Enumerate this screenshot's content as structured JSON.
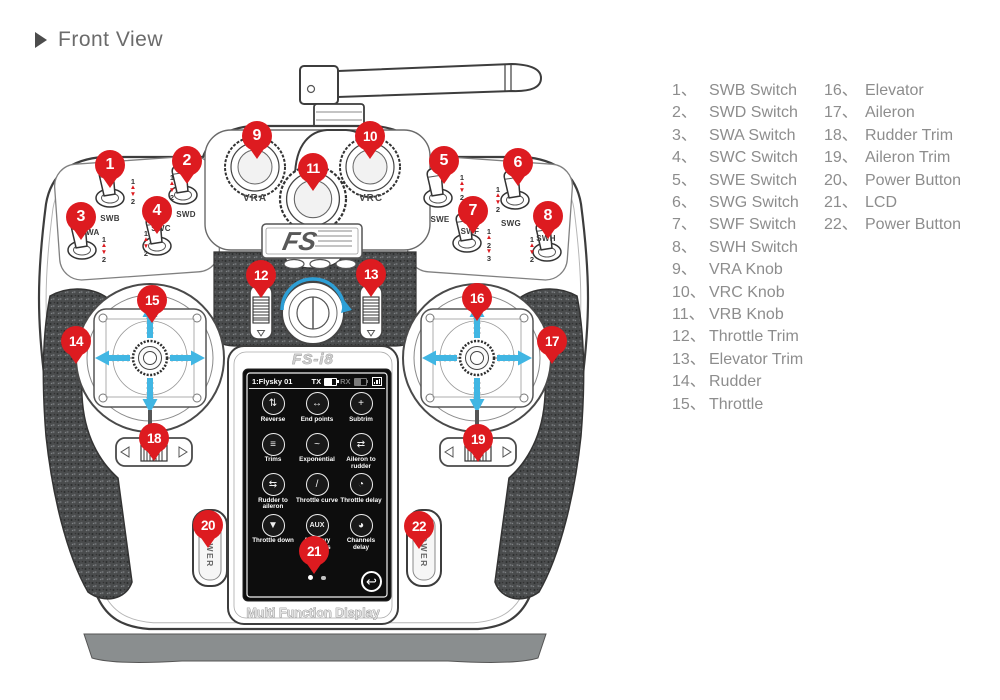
{
  "title": "Front View",
  "colors": {
    "marker-red": "#dd1b20",
    "arrow-cyan": "#41b6e3",
    "arc-blue": "#2d9fd6",
    "legend-gray": "#8d8d8d",
    "line-dark": "#3d3d3d",
    "lcd-bg": "#0d0d0d",
    "base-gray": "#8a8e8f"
  },
  "legend": {
    "separator": "、",
    "items": [
      {
        "num": "1",
        "label": "SWB Switch"
      },
      {
        "num": "2",
        "label": "SWD Switch"
      },
      {
        "num": "3",
        "label": "SWA Switch"
      },
      {
        "num": "4",
        "label": "SWC Switch"
      },
      {
        "num": "5",
        "label": "SWE  Switch"
      },
      {
        "num": "6",
        "label": "SWG Switch"
      },
      {
        "num": "7",
        "label": "SWF  Switch"
      },
      {
        "num": "8",
        "label": "SWH Switch"
      },
      {
        "num": "9",
        "label": "VRA Knob"
      },
      {
        "num": "10",
        "label": "VRC Knob"
      },
      {
        "num": "11",
        "label": "VRB Knob"
      },
      {
        "num": "12",
        "label": "Throttle Trim"
      },
      {
        "num": "13",
        "label": "Elevator Trim"
      },
      {
        "num": "14",
        "label": "Rudder"
      },
      {
        "num": "15",
        "label": "Throttle"
      },
      {
        "num": "16",
        "label": "Elevator"
      },
      {
        "num": "17",
        "label": "Aileron"
      },
      {
        "num": "18",
        "label": "Rudder Trim"
      },
      {
        "num": "19",
        "label": "Aileron Trim"
      },
      {
        "num": "20",
        "label": "Power Button"
      },
      {
        "num": "21",
        "label": "LCD"
      },
      {
        "num": "22",
        "label": "Power Button"
      }
    ]
  },
  "markers": [
    "1",
    "2",
    "3",
    "4",
    "5",
    "6",
    "7",
    "8",
    "9",
    "10",
    "11",
    "12",
    "13",
    "14",
    "15",
    "16",
    "17",
    "18",
    "19",
    "20",
    "21",
    "22"
  ],
  "device": {
    "brand_logo": "FS",
    "model_name": "FS-i8",
    "display_caption": "Multi Function Display",
    "power_button_label": "POWER",
    "knob_labels": {
      "left": "VRA",
      "right": "VRC"
    },
    "switches": [
      {
        "label": "SWB",
        "positions": [
          "1",
          "2"
        ]
      },
      {
        "label": "SWD",
        "positions": [
          "1",
          "2"
        ]
      },
      {
        "label": "SWA",
        "positions": [
          "1",
          "2"
        ]
      },
      {
        "label": "SWC",
        "positions": [
          "1",
          "2"
        ]
      },
      {
        "label": "SWE",
        "positions": [
          "1",
          "2"
        ]
      },
      {
        "label": "SWG",
        "positions": [
          "1",
          "2"
        ]
      },
      {
        "label": "SWF",
        "positions": [
          "1",
          "2",
          "3"
        ]
      },
      {
        "label": "SWH",
        "positions": [
          "1",
          "2"
        ]
      }
    ],
    "lcd": {
      "status": {
        "model": "1:Flysky 01",
        "tx": "TX",
        "rx": "RX"
      },
      "menu": [
        {
          "label": "Reverse",
          "glyph": "⇅"
        },
        {
          "label": "End points",
          "glyph": "↔"
        },
        {
          "label": "Subtrim",
          "glyph": "+"
        },
        {
          "label": "Trims",
          "glyph": "≡"
        },
        {
          "label": "Exponential",
          "glyph": "~"
        },
        {
          "label": "Aileron to rudder",
          "glyph": "⇄"
        },
        {
          "label": "Rudder to aileron",
          "glyph": "⇆"
        },
        {
          "label": "Throttle curve",
          "glyph": "/"
        },
        {
          "label": "Throttle delay",
          "glyph": "◔"
        },
        {
          "label": "Throttle down",
          "glyph": "▼"
        },
        {
          "label": "Auxiliary channels",
          "glyph": "AUX"
        },
        {
          "label": "Channels delay",
          "glyph": "◕"
        }
      ]
    }
  }
}
